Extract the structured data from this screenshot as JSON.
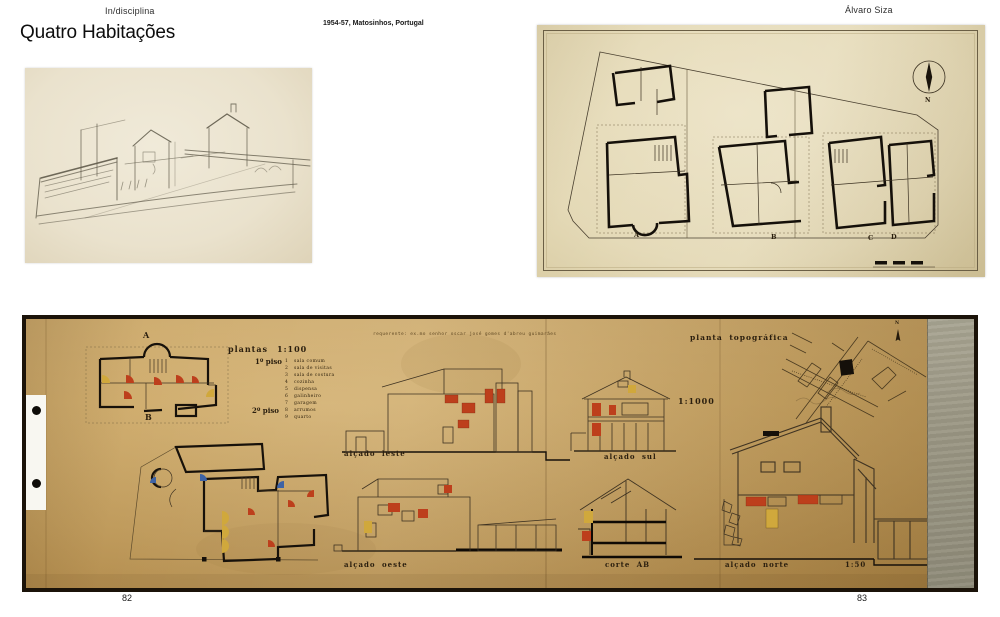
{
  "book": {
    "series_title": "In/disciplina",
    "page_title": "Quatro Habitações",
    "project_caption": "1954-57, Matosinhos, Portugal",
    "author": "Álvaro Siza",
    "page_left": "82",
    "page_right": "83"
  },
  "site_plan": {
    "north_label": "N",
    "house_labels": [
      "A",
      "B",
      "C",
      "D"
    ]
  },
  "worksheet": {
    "client_note": "requerente: ex.mo senhor oscar josé gomes d'abreu guimarães",
    "plans_label": "plantas",
    "plans_scale": "1:100",
    "floor1_label": "1º piso",
    "floor2_label": "2º piso",
    "legend": [
      {
        "num": "1",
        "name": "sala comum"
      },
      {
        "num": "2",
        "name": "sala de visitas"
      },
      {
        "num": "3",
        "name": "sala de costura"
      },
      {
        "num": "4",
        "name": "cozinha"
      },
      {
        "num": "5",
        "name": "dispensa"
      },
      {
        "num": "6",
        "name": "galinheiro"
      },
      {
        "num": "7",
        "name": "garagem"
      },
      {
        "num": "8",
        "name": "arrumos"
      },
      {
        "num": "9",
        "name": "quarto"
      }
    ],
    "plan_top_label": "A",
    "plan_bottom_label": "B",
    "topo_label": "planta topográfica",
    "topo_north": "N",
    "topo_scale": "1:1000",
    "elev_east_label": "alçado leste",
    "elev_south_label": "alçado sul",
    "elev_west_label": "alçado oeste",
    "section_label": "corte  AB",
    "elev_north_label": "alçado norte",
    "detail_scale": "1:50"
  },
  "colors": {
    "accent_red": "#bd3f1c",
    "accent_yellow": "#d0a83c",
    "accent_blue": "#3e63a5",
    "sheet_paper": "#c9a463",
    "plan_paper": "#e4d9b6",
    "sketch_paper": "#eae2cd",
    "ink": "#1a1208"
  }
}
